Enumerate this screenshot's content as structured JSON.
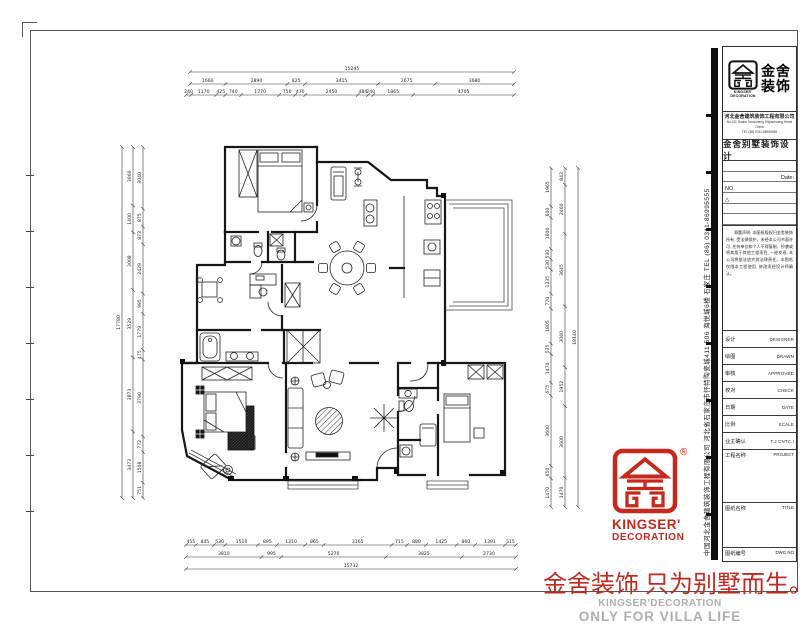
{
  "title_block": {
    "logo": {
      "cn_line1": "金舍",
      "cn_line2": "装饰",
      "en_line1": "KINGSER'",
      "en_line2": "DECORATION",
      "registered": "®"
    },
    "company_cn": "河北金舍建筑装饰工程有限公司",
    "address_line1": "No.411 Huaite Taocicheng Shijiazhuang Hebei China",
    "address_line2": "TEL:(86) 0311-86995555",
    "doc_title": "金舍别墅装饰设计",
    "date_label": "Date:",
    "no_label": "NO.",
    "delta_mark": "△",
    "notice": "郑重声明: 本图纸版权归金舍装饰所有, 受法律保护。未经本公司书面许可, 任何单位和个人不得复制、抄袭或将其用于其他工程项目, 一经发现, 本公司将依法追究其法律责任。本图纸仅限本工程使用, 修改须经设计师确认。",
    "rows": [
      {
        "cn": "设计",
        "en": "DESIGNER"
      },
      {
        "cn": "绘图",
        "en": "DRAWN"
      },
      {
        "cn": "审核",
        "en": "APPROVED"
      },
      {
        "cn": "校对",
        "en": "CHECK"
      },
      {
        "cn": "日期",
        "en": "DATE"
      },
      {
        "cn": "比例",
        "en": "SCALE"
      },
      {
        "cn": "业主确认",
        "en": "T.J CNTC.I"
      }
    ],
    "project_row": {
      "cn": "工程名称",
      "en": "PROJECT"
    },
    "title_row": {
      "cn": "图纸名称",
      "en": "TITLE"
    },
    "dwg_row": {
      "cn": "图纸编号",
      "en": "DWG.NO"
    }
  },
  "side_text": "中国河北金舍建筑装饰工程有限公司  河北省石家庄市怀特陶瓷城411 506 海悦城6楼 石家庄 TEL (86) 0311-86995555",
  "footer": {
    "slogan": "金舍装饰 只为别墅而生。",
    "en_line1": "KINGSER'DECORATION",
    "en_line2": "ONLY FOR VILLA LIFE"
  },
  "brand": {
    "red": "#c5281c",
    "slogan_red": "#c02a20",
    "gray": "#aeaeae",
    "black": "#111111"
  },
  "dimensions": {
    "top_overall": "15245",
    "top_row_a": [
      "1660",
      "2890",
      "825",
      "3415",
      "2675",
      "3680"
    ],
    "top_row_b": [
      "240",
      "1170",
      "425",
      "740",
      "1770",
      "750",
      "470",
      "2450",
      "484",
      "240",
      "1865",
      "4705"
    ],
    "bottom_row_a": [
      "455",
      "845",
      "530",
      "1510",
      "895",
      "1310",
      "865",
      "3165",
      "715",
      "880",
      "1425",
      "860",
      "1391",
      "515"
    ],
    "bottom_row_b": [
      "3810",
      "995",
      "5270",
      "3825",
      "2730"
    ],
    "bottom_overall": "15732",
    "left_overall": "17780",
    "left_row_a": [
      "3060",
      "1400",
      "3008",
      "3529",
      "3873",
      "3473"
    ],
    "left_row_b": [
      "3040",
      "875",
      "873",
      "2429",
      "995",
      "1779",
      "475",
      "3790",
      "772",
      "1508",
      "751"
    ],
    "right_overall": "18140",
    "right_row_a": [
      "843",
      "2460",
      "3645",
      "3060",
      "1952",
      "3600",
      "1470"
    ],
    "right_row_b": [
      "1965",
      "600",
      "1600",
      "530",
      "530",
      "1235",
      "770",
      "1805",
      "535",
      "1470",
      "675",
      "3600",
      "650",
      "1470"
    ]
  }
}
